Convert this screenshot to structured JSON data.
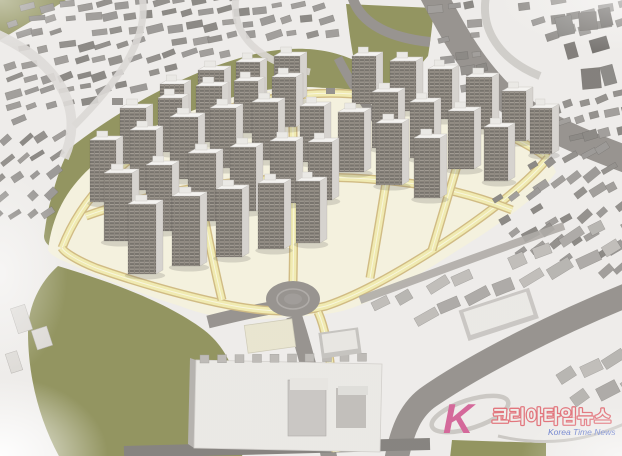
{
  "watermark": {
    "logo_letter": "K",
    "brand_text": "코리아타임뉴스",
    "sub_text": "Korea Time News"
  },
  "palette": {
    "base_ground": "#edebe8",
    "grass": "#8b8d55",
    "site_ground": "#f3f0db",
    "road_grey": "#908c88",
    "road_dark": "#7e7b77",
    "road_yellow": "#efe9ab",
    "road_yellow_edge": "#cdb67b",
    "fabric_building": "#8f8c88",
    "fabric_building_dark": "#767370",
    "slab_grey": "#c6c3bf",
    "roof_white": "#f3f2ef",
    "tower_side": "#d3d0cb",
    "tower_window_dark": "#6e6962",
    "tower_window_light": "#9c968c",
    "watermark_pink": "#cf4f8a",
    "watermark_outline_red": "#df5f68",
    "watermark_text_fill": "#efede9",
    "watermark_blue": "#4a63c4",
    "swoosh_grey": "#c3c0bc"
  }
}
